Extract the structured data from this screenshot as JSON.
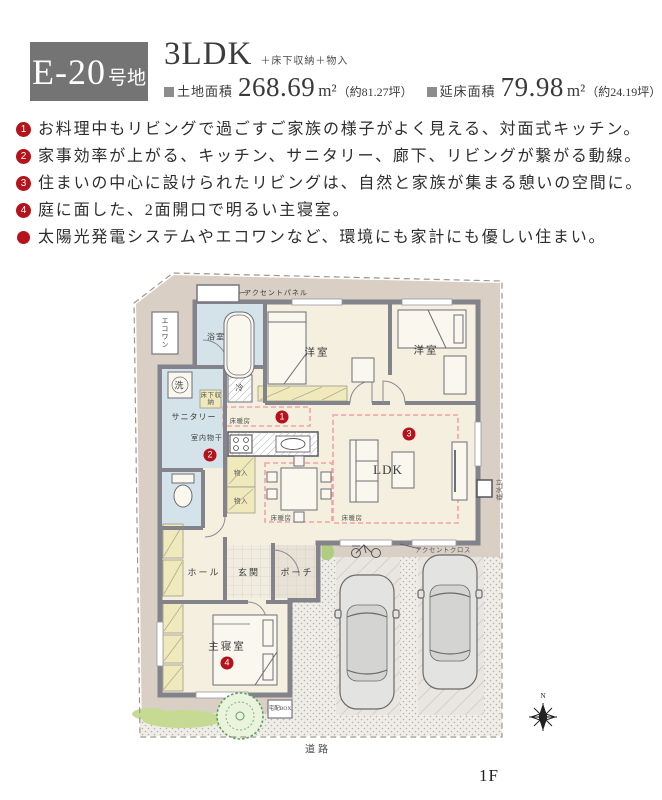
{
  "header": {
    "lot_badge": {
      "prefix": "E-20",
      "suffix": "号地"
    },
    "plan_type": "3LDK",
    "plan_extras": "＋床下収納＋物入",
    "areas": [
      {
        "label": "土地面積",
        "value": "268.69",
        "unit": "m²",
        "note": "（約81.27坪）"
      },
      {
        "label": "延床面積",
        "value": "79.98",
        "unit": "m²",
        "note": "（約24.19坪）"
      }
    ]
  },
  "features": [
    {
      "marker": "1",
      "text": "お料理中もリビングで過ごすご家族の様子がよく見える、対面式キッチン。"
    },
    {
      "marker": "2",
      "text": "家事効率が上がる、キッチン、サニタリー、廊下、リビングが繋がる動線。"
    },
    {
      "marker": "3",
      "text": "住まいの中心に設けられたリビングは、自然と家族が集まる憩いの空間に。"
    },
    {
      "marker": "4",
      "text": "庭に面した、2面開口で明るい主寝室。"
    },
    {
      "marker": "",
      "text": "太陽光発電システムやエコワンなど、環境にも家計にも優しい住まい。"
    }
  ],
  "floor_plan": {
    "labels": {
      "accent_panel": "アクセントパネル",
      "ecoone": "エコワン",
      "bath": "浴室",
      "wash": "洗",
      "underfloor_storage": "床下収納",
      "sanitary": "サニタリー",
      "indoor_drying": "室内物干",
      "fridge": "冷",
      "western_room": "洋室",
      "ldk": "LDK",
      "floor_heating": "床暖房",
      "closet": "物入",
      "hall": "ホール",
      "entrance": "玄関",
      "porch": "ポーチ",
      "master_bedroom": "主寝室",
      "accent_cloth": "アクセントクロス",
      "delivery_box": "宅配BOX",
      "water_tap": "立水栓",
      "road": "道路",
      "compass_n": "N",
      "floor": "1F"
    },
    "markers": [
      "1",
      "2",
      "3",
      "4"
    ]
  },
  "colors": {
    "badge_gray": "#747474",
    "marker_red": "#b5121b",
    "site_beige": "#d9cfc4",
    "wall_gray": "#83838b",
    "room_cream": "#f4efdf",
    "wet_blue": "#d4e2ea",
    "closet_yellow": "#efe9bb",
    "floor_heating_pink": "#f0a3a8"
  }
}
